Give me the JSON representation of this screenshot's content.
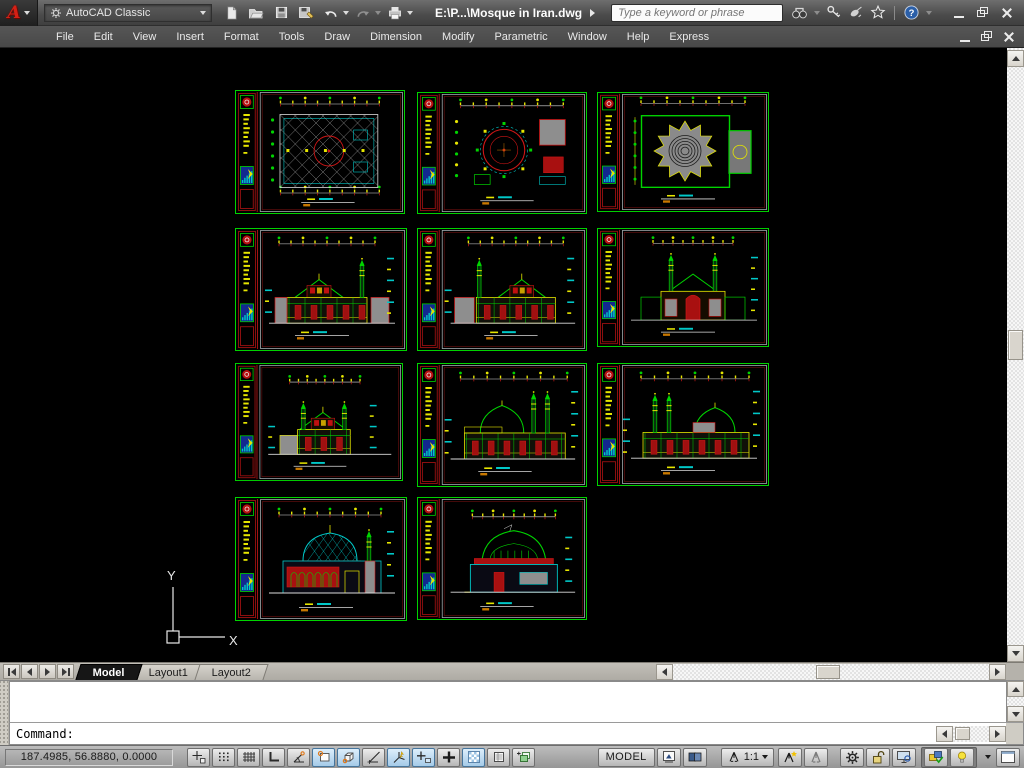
{
  "titlebar": {
    "workspace": "AutoCAD Classic",
    "title": "E:\\P...\\Mosque in Iran.dwg",
    "search_placeholder": "Type a keyword or phrase",
    "logo_letter": "A",
    "help_glyph": "?"
  },
  "menus": [
    "File",
    "Edit",
    "View",
    "Insert",
    "Format",
    "Tools",
    "Draw",
    "Dimension",
    "Modify",
    "Parametric",
    "Window",
    "Help",
    "Express"
  ],
  "tabs": {
    "items": [
      {
        "label": "Model",
        "active": true
      },
      {
        "label": "Layout1",
        "active": false
      },
      {
        "label": "Layout2",
        "active": false
      }
    ]
  },
  "command": {
    "history": [
      "Command:  <Object Snap Tracking off>",
      "Command: _.CLEANSCREENON"
    ],
    "prompt": "Command:"
  },
  "statusbar": {
    "coords": "187.4985, 56.8880, 0.0000",
    "toggles": [
      {
        "name": "infer-constraints",
        "pressed": false
      },
      {
        "name": "snap-mode",
        "pressed": false
      },
      {
        "name": "grid-display",
        "pressed": false
      },
      {
        "name": "ortho-mode",
        "pressed": false
      },
      {
        "name": "polar-tracking",
        "pressed": false
      },
      {
        "name": "object-snap",
        "pressed": true
      },
      {
        "name": "3d-object-snap",
        "pressed": true
      },
      {
        "name": "object-snap-tracking",
        "pressed": false
      },
      {
        "name": "dynamic-ucs",
        "pressed": true
      },
      {
        "name": "dynamic-input",
        "pressed": true
      },
      {
        "name": "lineweight",
        "pressed": false
      },
      {
        "name": "transparency",
        "pressed": true
      },
      {
        "name": "quick-properties",
        "pressed": false
      },
      {
        "name": "selection-cycling",
        "pressed": false
      }
    ],
    "model_label": "MODEL",
    "annotation_scale": "1:1"
  },
  "ucs": {
    "x_label": "X",
    "y_label": "Y"
  },
  "palette": {
    "green": "#00d400",
    "red": "#cf1616",
    "yellow": "#e6e600",
    "cyan": "#00c8c8",
    "gray": "#9a9a9a",
    "blue": "#12288f",
    "white": "#dcdcdc"
  },
  "sheets": [
    {
      "kind": "floor-plan-hatched",
      "x": 235,
      "y": 42,
      "w": 170,
      "h": 124
    },
    {
      "kind": "floor-plan-dome",
      "x": 417,
      "y": 44,
      "w": 170,
      "h": 122
    },
    {
      "kind": "roof-plan",
      "x": 597,
      "y": 44,
      "w": 172,
      "h": 120
    },
    {
      "kind": "elevation-minaret-right",
      "x": 235,
      "y": 180,
      "w": 172,
      "h": 123
    },
    {
      "kind": "elevation-minaret-left",
      "x": 417,
      "y": 180,
      "w": 170,
      "h": 123
    },
    {
      "kind": "elevation-front",
      "x": 597,
      "y": 180,
      "w": 172,
      "h": 119
    },
    {
      "kind": "elevation-small",
      "x": 235,
      "y": 315,
      "w": 168,
      "h": 118
    },
    {
      "kind": "elevation-wide-minarets",
      "x": 417,
      "y": 315,
      "w": 170,
      "h": 124
    },
    {
      "kind": "elevation-dome-right",
      "x": 597,
      "y": 315,
      "w": 172,
      "h": 123
    },
    {
      "kind": "section-dome-lattice",
      "x": 235,
      "y": 449,
      "w": 172,
      "h": 124
    },
    {
      "kind": "section-dome-green",
      "x": 417,
      "y": 449,
      "w": 170,
      "h": 123
    }
  ]
}
